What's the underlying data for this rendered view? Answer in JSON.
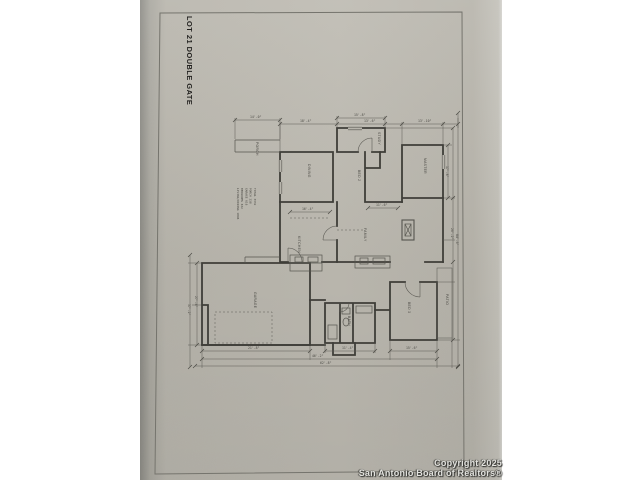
{
  "photo": {
    "sheet_title": "LOT 21 DOUBLE GATE",
    "watermark": {
      "line1": "Copyright 2025",
      "line2": "San Antonio Board of Realtors®"
    },
    "colors": {
      "page_background": "#ffffff",
      "paper": "#b8b5ac",
      "wall_line": "#3f3e39",
      "thin_line": "#5c5b54",
      "title_text": "#22211f",
      "watermark_text": "#e3e3df"
    }
  },
  "floor_plan": {
    "area_table": [
      "LIVING/DINING  1846",
      "BEDROOMS        632",
      "GARAGE          616",
      "PORCH           238",
      "TOTAL          3332"
    ],
    "room_labels": [
      {
        "x": 168,
        "y": 164,
        "t": "DINING"
      },
      {
        "x": 158,
        "y": 236,
        "t": "KITCHEN"
      },
      {
        "x": 218,
        "y": 170,
        "t": "BED 2"
      },
      {
        "x": 284,
        "y": 158,
        "t": "MASTER"
      },
      {
        "x": 224,
        "y": 228,
        "t": "FAMILY"
      },
      {
        "x": 114,
        "y": 292,
        "t": "GARAGE"
      },
      {
        "x": 208,
        "y": 316,
        "t": "BATH"
      },
      {
        "x": 268,
        "y": 302,
        "t": "BED 3"
      },
      {
        "x": 306,
        "y": 294,
        "t": "PATIO"
      },
      {
        "x": 116,
        "y": 142,
        "t": "PORCH"
      },
      {
        "x": 238,
        "y": 132,
        "t": "STUDY"
      }
    ],
    "dimensions": [
      {
        "x": 214,
        "y": 116,
        "o": "h",
        "t": "15'-8\""
      },
      {
        "x": 160,
        "y": 122,
        "o": "h",
        "t": "18'-4\""
      },
      {
        "x": 224,
        "y": 122,
        "o": "h",
        "t": "13'-6\""
      },
      {
        "x": 278,
        "y": 122,
        "o": "h",
        "t": "13'-10\""
      },
      {
        "x": 110,
        "y": 118,
        "o": "h",
        "t": "14'-0\""
      },
      {
        "x": 55,
        "y": 296,
        "o": "v",
        "t": "27'-4\""
      },
      {
        "x": 48,
        "y": 304,
        "o": "v",
        "t": "37'-2\""
      },
      {
        "x": 306,
        "y": 166,
        "o": "v",
        "t": "17'-8\""
      },
      {
        "x": 311,
        "y": 228,
        "o": "v",
        "t": "26'-2\""
      },
      {
        "x": 316,
        "y": 234,
        "o": "v",
        "t": "84'-6\""
      },
      {
        "x": 108,
        "y": 349,
        "o": "h",
        "t": "21'-8\""
      },
      {
        "x": 202,
        "y": 349,
        "o": "h",
        "t": "11'-4\""
      },
      {
        "x": 266,
        "y": 349,
        "o": "h",
        "t": "15'-6\""
      },
      {
        "x": 172,
        "y": 357,
        "o": "h",
        "t": "46'-2\""
      },
      {
        "x": 180,
        "y": 364,
        "o": "h",
        "t": "62'-8\""
      },
      {
        "x": 162,
        "y": 210,
        "o": "h",
        "t": "16'-4\""
      },
      {
        "x": 236,
        "y": 206,
        "o": "h",
        "t": "11'-6\""
      }
    ]
  }
}
